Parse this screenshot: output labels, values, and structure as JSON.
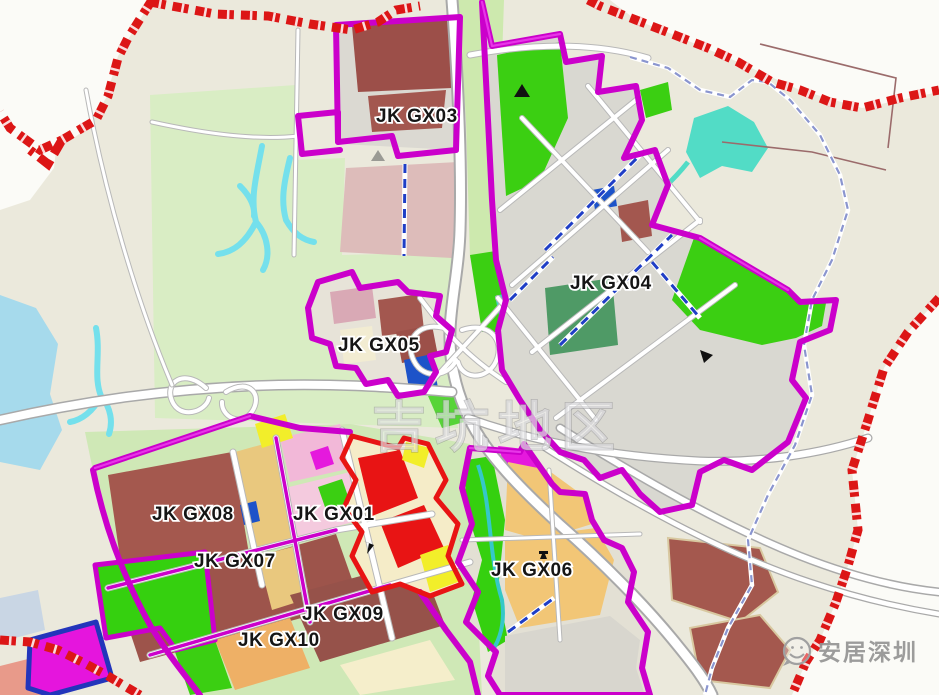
{
  "map": {
    "watermark_text": "吉坑地区",
    "brand_text": "安居深圳",
    "zone_labels": [
      {
        "id": "gx03",
        "text": "JK GX03"
      },
      {
        "id": "gx04",
        "text": "JK GX04"
      },
      {
        "id": "gx05",
        "text": "JK GX05"
      },
      {
        "id": "gx08",
        "text": "JK GX08"
      },
      {
        "id": "gx01",
        "text": "JK GX01"
      },
      {
        "id": "gx07",
        "text": "JK GX07"
      },
      {
        "id": "gx09",
        "text": "JK GX09"
      },
      {
        "id": "gx10",
        "text": "JK GX10"
      },
      {
        "id": "gx06",
        "text": "JK GX06"
      }
    ],
    "palette": {
      "zone_boundary_magenta": "#cb00cb",
      "city_boundary_red": "#dc1616",
      "park_green": "#3bcf12",
      "residential_brown": "#a4584e",
      "industry_yellow": "#f2ee2a",
      "commercial_red": "#e81414",
      "institution_blue": "#1d53c9",
      "village_tan": "#e9c87e",
      "water_blue": "#a6daec",
      "stream_cyan": "#52dcc6",
      "background": "#ebe9dc"
    },
    "icons": {
      "landmark_triangle": "▲",
      "boundary_flag": "⚑"
    }
  }
}
